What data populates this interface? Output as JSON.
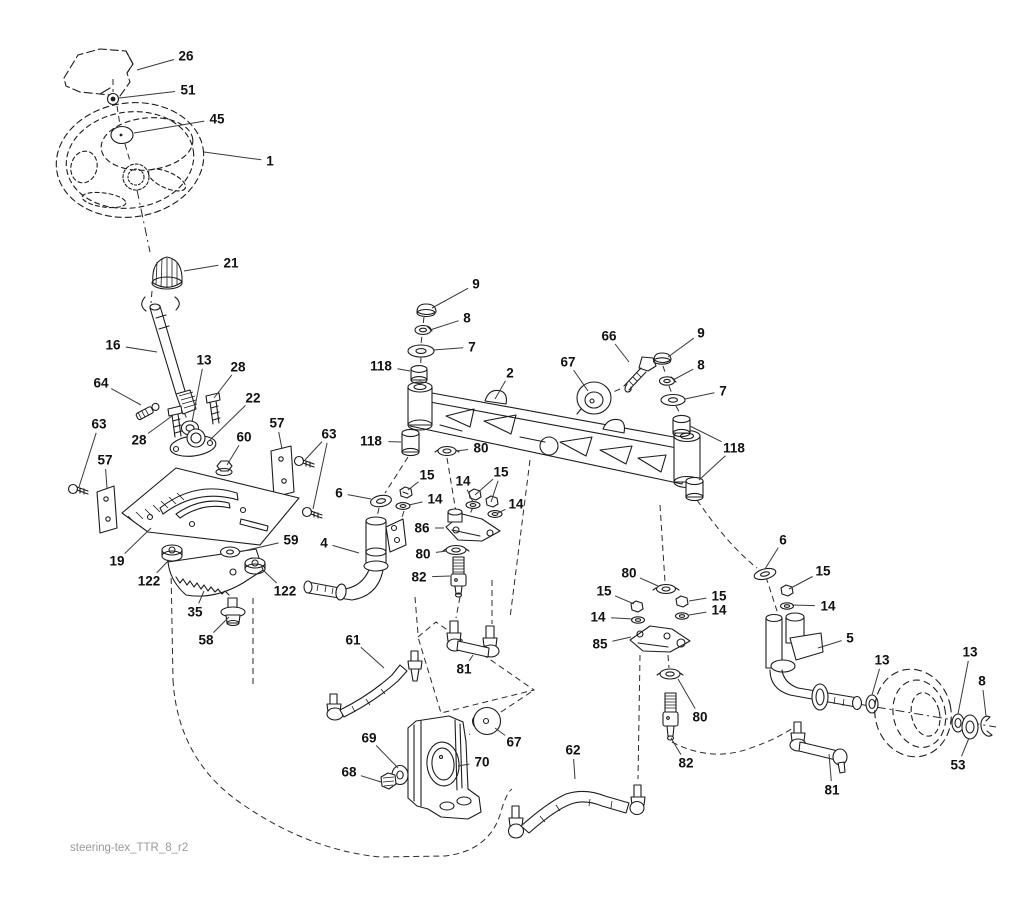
{
  "meta": {
    "drawing_type": "exploded parts diagram",
    "subject": "tractor steering assembly"
  },
  "colors": {
    "ink": "#1d1d1d",
    "leader": "#3a3a3a",
    "label": "#111111",
    "footer": "#9a9a9a",
    "background": "#ffffff"
  },
  "footer": {
    "drawing_code": "steering-tex_TTR_8_r2"
  },
  "part_numbers_visible": [
    "1",
    "2",
    "4",
    "5",
    "6",
    "7",
    "8",
    "9",
    "13",
    "14",
    "15",
    "16",
    "19",
    "21",
    "22",
    "26",
    "28",
    "35",
    "45",
    "51",
    "53",
    "57",
    "58",
    "59",
    "60",
    "61",
    "62",
    "63",
    "64",
    "66",
    "67",
    "68",
    "69",
    "70",
    "80",
    "81",
    "82",
    "85",
    "86",
    "118",
    "122"
  ],
  "callouts": [
    {
      "label": "26",
      "x": 186,
      "y": 56,
      "targets": [
        [
          137,
          70
        ]
      ]
    },
    {
      "label": "51",
      "x": 188,
      "y": 90,
      "targets": [
        [
          119,
          98
        ]
      ]
    },
    {
      "label": "45",
      "x": 217,
      "y": 119,
      "targets": [
        [
          134,
          133
        ]
      ]
    },
    {
      "label": "1",
      "x": 270,
      "y": 161,
      "targets": [
        [
          204,
          152
        ]
      ]
    },
    {
      "label": "21",
      "x": 231,
      "y": 263,
      "targets": [
        [
          184,
          271
        ]
      ]
    },
    {
      "label": "16",
      "x": 113,
      "y": 345,
      "targets": [
        [
          157,
          352
        ]
      ]
    },
    {
      "label": "13",
      "x": 204,
      "y": 360,
      "targets": [
        [
          192,
          422
        ]
      ]
    },
    {
      "label": "28",
      "x": 238,
      "y": 367,
      "targets": [
        [
          214,
          398
        ]
      ]
    },
    {
      "label": "64",
      "x": 101,
      "y": 383,
      "targets": [
        [
          141,
          405
        ]
      ]
    },
    {
      "label": "22",
      "x": 253,
      "y": 398,
      "targets": [
        [
          209,
          441
        ]
      ]
    },
    {
      "label": "63",
      "x": 99,
      "y": 424,
      "targets": [
        [
          79,
          487
        ]
      ]
    },
    {
      "label": "57",
      "x": 277,
      "y": 423,
      "targets": [
        [
          282,
          449
        ]
      ]
    },
    {
      "label": "60",
      "x": 244,
      "y": 437,
      "targets": [
        [
          227,
          465
        ]
      ]
    },
    {
      "label": "63",
      "x": 329,
      "y": 434,
      "targets": [
        [
          305,
          460
        ],
        [
          313,
          509
        ]
      ]
    },
    {
      "label": "28",
      "x": 139,
      "y": 440,
      "targets": [
        [
          172,
          416
        ]
      ]
    },
    {
      "label": "57",
      "x": 105,
      "y": 460,
      "targets": [
        [
          107,
          488
        ]
      ]
    },
    {
      "label": "19",
      "x": 117,
      "y": 561,
      "targets": [
        [
          151,
          528
        ]
      ]
    },
    {
      "label": "122",
      "x": 149,
      "y": 581,
      "targets": [
        [
          169,
          560
        ]
      ]
    },
    {
      "label": "59",
      "x": 291,
      "y": 540,
      "targets": [
        [
          239,
          552
        ]
      ]
    },
    {
      "label": "122",
      "x": 285,
      "y": 591,
      "targets": [
        [
          263,
          570
        ]
      ]
    },
    {
      "label": "35",
      "x": 195,
      "y": 612,
      "targets": [
        [
          204,
          591
        ]
      ]
    },
    {
      "label": "58",
      "x": 206,
      "y": 640,
      "targets": [
        [
          229,
          617
        ]
      ]
    },
    {
      "label": "9",
      "x": 476,
      "y": 284,
      "targets": [
        [
          432,
          308
        ]
      ]
    },
    {
      "label": "8",
      "x": 467,
      "y": 318,
      "targets": [
        [
          430,
          330
        ]
      ]
    },
    {
      "label": "7",
      "x": 472,
      "y": 347,
      "targets": [
        [
          433,
          350
        ]
      ]
    },
    {
      "label": "118",
      "x": 381,
      "y": 366,
      "targets": [
        [
          410,
          371
        ]
      ]
    },
    {
      "label": "2",
      "x": 510,
      "y": 373,
      "targets": [
        [
          495,
          399
        ]
      ]
    },
    {
      "label": "67",
      "x": 568,
      "y": 362,
      "targets": [
        [
          588,
          391
        ]
      ]
    },
    {
      "label": "66",
      "x": 609,
      "y": 336,
      "targets": [
        [
          629,
          362
        ]
      ]
    },
    {
      "label": "9",
      "x": 701,
      "y": 333,
      "targets": [
        [
          668,
          357
        ]
      ]
    },
    {
      "label": "8",
      "x": 701,
      "y": 365,
      "targets": [
        [
          673,
          380
        ]
      ]
    },
    {
      "label": "7",
      "x": 723,
      "y": 391,
      "targets": [
        [
          685,
          399
        ]
      ]
    },
    {
      "label": "118",
      "x": 734,
      "y": 448,
      "targets": [
        [
          690,
          426
        ],
        [
          699,
          480
        ]
      ]
    },
    {
      "label": "118",
      "x": 371,
      "y": 441,
      "targets": [
        [
          401,
          442
        ]
      ]
    },
    {
      "label": "80",
      "x": 481,
      "y": 448,
      "targets": [
        [
          456,
          451
        ]
      ]
    },
    {
      "label": "15",
      "x": 427,
      "y": 475,
      "targets": [
        [
          408,
          490
        ]
      ]
    },
    {
      "label": "14",
      "x": 435,
      "y": 499,
      "targets": [
        [
          409,
          505
        ]
      ]
    },
    {
      "label": "6",
      "x": 339,
      "y": 493,
      "targets": [
        [
          371,
          499
        ]
      ]
    },
    {
      "label": "14",
      "x": 463,
      "y": 481,
      "targets": [
        [
          473,
          502
        ]
      ]
    },
    {
      "label": "15",
      "x": 501,
      "y": 472,
      "targets": [
        [
          475,
          495
        ],
        [
          491,
          502
        ]
      ]
    },
    {
      "label": "14",
      "x": 516,
      "y": 504,
      "targets": [
        [
          498,
          513
        ]
      ]
    },
    {
      "label": "86",
      "x": 422,
      "y": 528,
      "targets": [
        [
          444,
          528
        ]
      ]
    },
    {
      "label": "4",
      "x": 324,
      "y": 543,
      "targets": [
        [
          359,
          553
        ]
      ]
    },
    {
      "label": "80",
      "x": 423,
      "y": 554,
      "targets": [
        [
          447,
          551
        ]
      ]
    },
    {
      "label": "82",
      "x": 419,
      "y": 577,
      "targets": [
        [
          450,
          576
        ]
      ]
    },
    {
      "label": "61",
      "x": 353,
      "y": 640,
      "targets": [
        [
          384,
          668
        ]
      ]
    },
    {
      "label": "81",
      "x": 464,
      "y": 669,
      "targets": [
        [
          473,
          655
        ]
      ]
    },
    {
      "label": "85",
      "x": 600,
      "y": 644,
      "targets": [
        [
          631,
          637
        ]
      ]
    },
    {
      "label": "80",
      "x": 629,
      "y": 573,
      "targets": [
        [
          658,
          586
        ]
      ]
    },
    {
      "label": "15",
      "x": 604,
      "y": 591,
      "targets": [
        [
          634,
          604
        ]
      ]
    },
    {
      "label": "14",
      "x": 598,
      "y": 617,
      "targets": [
        [
          633,
          619
        ]
      ]
    },
    {
      "label": "15",
      "x": 719,
      "y": 596,
      "targets": [
        [
          689,
          601
        ]
      ]
    },
    {
      "label": "14",
      "x": 719,
      "y": 610,
      "targets": [
        [
          689,
          615
        ]
      ]
    },
    {
      "label": "6",
      "x": 783,
      "y": 540,
      "targets": [
        [
          765,
          569
        ]
      ]
    },
    {
      "label": "15",
      "x": 823,
      "y": 571,
      "targets": [
        [
          789,
          589
        ]
      ]
    },
    {
      "label": "14",
      "x": 828,
      "y": 606,
      "targets": [
        [
          792,
          605
        ]
      ]
    },
    {
      "label": "5",
      "x": 850,
      "y": 638,
      "targets": [
        [
          818,
          648
        ]
      ]
    },
    {
      "label": "80",
      "x": 700,
      "y": 717,
      "targets": [
        [
          678,
          679
        ]
      ]
    },
    {
      "label": "82",
      "x": 686,
      "y": 763,
      "targets": [
        [
          671,
          738
        ]
      ]
    },
    {
      "label": "13",
      "x": 882,
      "y": 660,
      "targets": [
        [
          872,
          695
        ]
      ]
    },
    {
      "label": "13",
      "x": 970,
      "y": 652,
      "targets": [
        [
          958,
          714
        ]
      ]
    },
    {
      "label": "8",
      "x": 982,
      "y": 681,
      "targets": [
        [
          986,
          716
        ]
      ]
    },
    {
      "label": "53",
      "x": 958,
      "y": 765,
      "targets": [
        [
          969,
          738
        ]
      ]
    },
    {
      "label": "81",
      "x": 832,
      "y": 790,
      "targets": [
        [
          829,
          754
        ]
      ]
    },
    {
      "label": "69",
      "x": 369,
      "y": 738,
      "targets": [
        [
          398,
          768
        ]
      ]
    },
    {
      "label": "68",
      "x": 349,
      "y": 772,
      "targets": [
        [
          381,
          782
        ]
      ]
    },
    {
      "label": "70",
      "x": 482,
      "y": 762,
      "targets": [
        [
          458,
          766
        ]
      ]
    },
    {
      "label": "67",
      "x": 514,
      "y": 742,
      "targets": [
        [
          495,
          728
        ]
      ]
    },
    {
      "label": "62",
      "x": 573,
      "y": 750,
      "targets": [
        [
          575,
          779
        ]
      ]
    }
  ]
}
